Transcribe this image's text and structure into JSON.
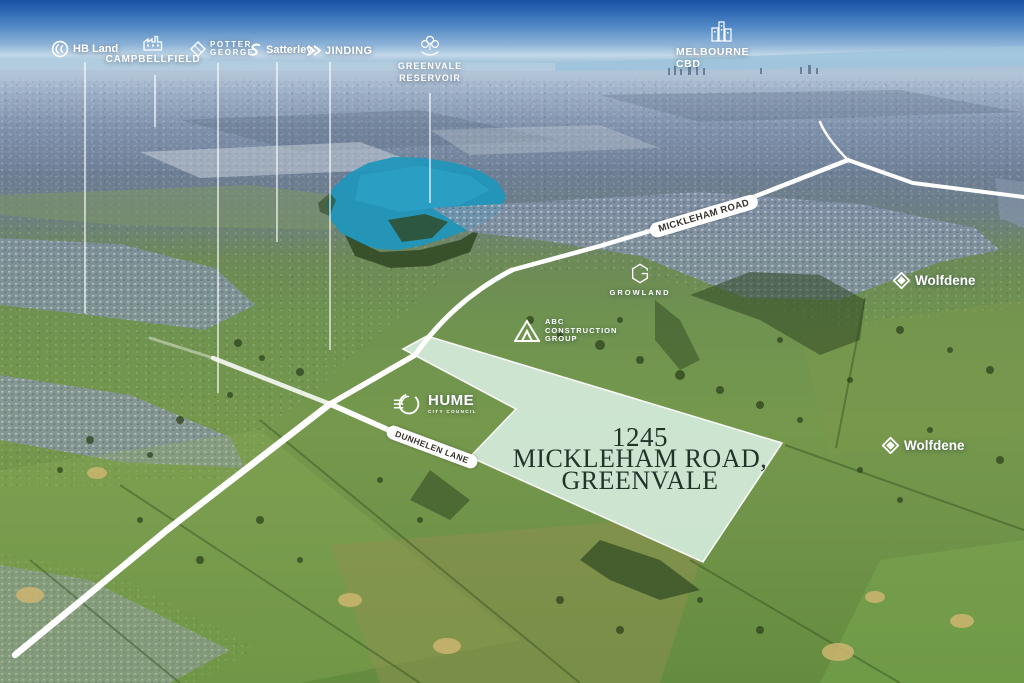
{
  "scene": "aerial-site-marketing-map",
  "developer_labels": {
    "hb_land": "HB Land",
    "campbellfield": "CAMPBELLFIELD",
    "potter_george_line1": "POTTER",
    "potter_george_line2": "GEORGE",
    "satterley": "Satterley",
    "jinding": "JINDING",
    "greenvale_reservoir_line1": "GREENVALE",
    "greenvale_reservoir_line2": "RESERVOIR",
    "melbourne_cbd": "MELBOURNE CBD",
    "growland": "GROWLAND",
    "abc_construction_line1": "ABC",
    "abc_construction_line2": "CONSTRUCTION",
    "abc_construction_line3": "GROUP",
    "hume": "HUME",
    "hume_sub": "CITY COUNCIL",
    "wolfdene_north": "Wolfdene",
    "wolfdene_south": "Wolfdene"
  },
  "roads": {
    "mickleham_road": "MICKLEHAM ROAD",
    "dunhelen_lane": "DUNHELEN LANE"
  },
  "site": {
    "address_line1": "1245",
    "address_line2": "MICKLEHAM ROAD,",
    "address_line3": "GREENVALE"
  },
  "icons": {
    "hb_land": "circle-monogram-icon",
    "campbellfield": "factory-icon",
    "potter_george": "gem-diamond-icon",
    "satterley": "s-swoosh-icon",
    "jinding": "double-chevron-icon",
    "greenvale_reservoir": "trees-water-icon",
    "melbourne_cbd": "city-buildings-icon",
    "growland": "hexagon-g-icon",
    "abc_construction": "triangle-icon",
    "hume": "hume-emblem-icon",
    "wolfdene": "diamond-logo-icon"
  },
  "colors": {
    "parcel_fill": "#d8efe2",
    "parcel_border": "#ffffff",
    "lake": "#2196bb",
    "road": "#ffffff",
    "address_text": "#223329",
    "label_text": "#ffffff",
    "road_label_text": "#37332c",
    "sky_top": "#1a52a3",
    "field_green": "#6f9350"
  }
}
